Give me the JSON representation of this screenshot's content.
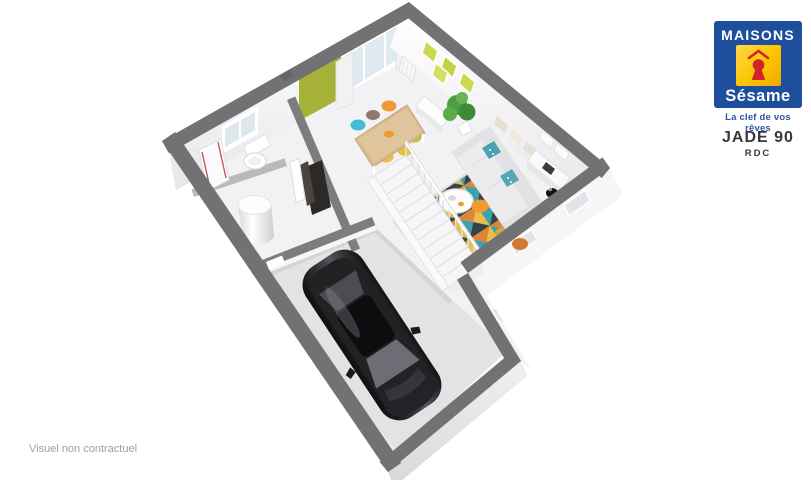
{
  "branding": {
    "maisons": "MAISONS",
    "sesame": "Sésame",
    "tagline": "La clef de vos rêves",
    "colors": {
      "blue": "#1d4f9c",
      "yellow": "#fcc400",
      "red": "#d3232a",
      "tagline_blue": "#2b55a4"
    }
  },
  "plan_title": {
    "model": "JADE 90",
    "level": "RDC"
  },
  "footer": {
    "disclaimer": "Visuel non contractuel"
  },
  "scene": {
    "type": "3d-floor-plan-render",
    "level": "ground-floor",
    "palette": {
      "wall_top": "#727275",
      "exterior_face": "#f6f6f8",
      "floor": "#f2f2f4",
      "garage_floor": "#e3e3e5",
      "accent_wall_green": "#a6b138",
      "sofa": "#ececee",
      "rug_teal": "#3f9fae",
      "rug_orange": "#df8632",
      "rug_mustard": "#e8bf4e",
      "rug_navy": "#31424c",
      "rug_cream": "#efe6d4",
      "wood": "#d8b88c",
      "car": "#1b1b1e",
      "plant": "#4a9e3f",
      "pouf_orange": "#ef9a33",
      "chair_teal": "#45bdd3",
      "chair_orange": "#f09a37",
      "chair_mustard": "#e8c13f",
      "chair_green": "#b4c832"
    },
    "elements": [
      "exterior-walls",
      "living-dining-room",
      "green-accent-wall",
      "bay-window-with-curtains",
      "dining-table-with-chairs",
      "sofa-with-cushions",
      "geometric-rug",
      "round-coffee-table",
      "orange-pouf",
      "green-plant",
      "wall-frames",
      "wall-shelves",
      "sideboard",
      "kitchen-units",
      "staircase-with-railing",
      "entrance-hall",
      "front-door",
      "wc-with-window",
      "water-heater",
      "garage",
      "black-car",
      "radiator",
      "facade-windows"
    ]
  }
}
